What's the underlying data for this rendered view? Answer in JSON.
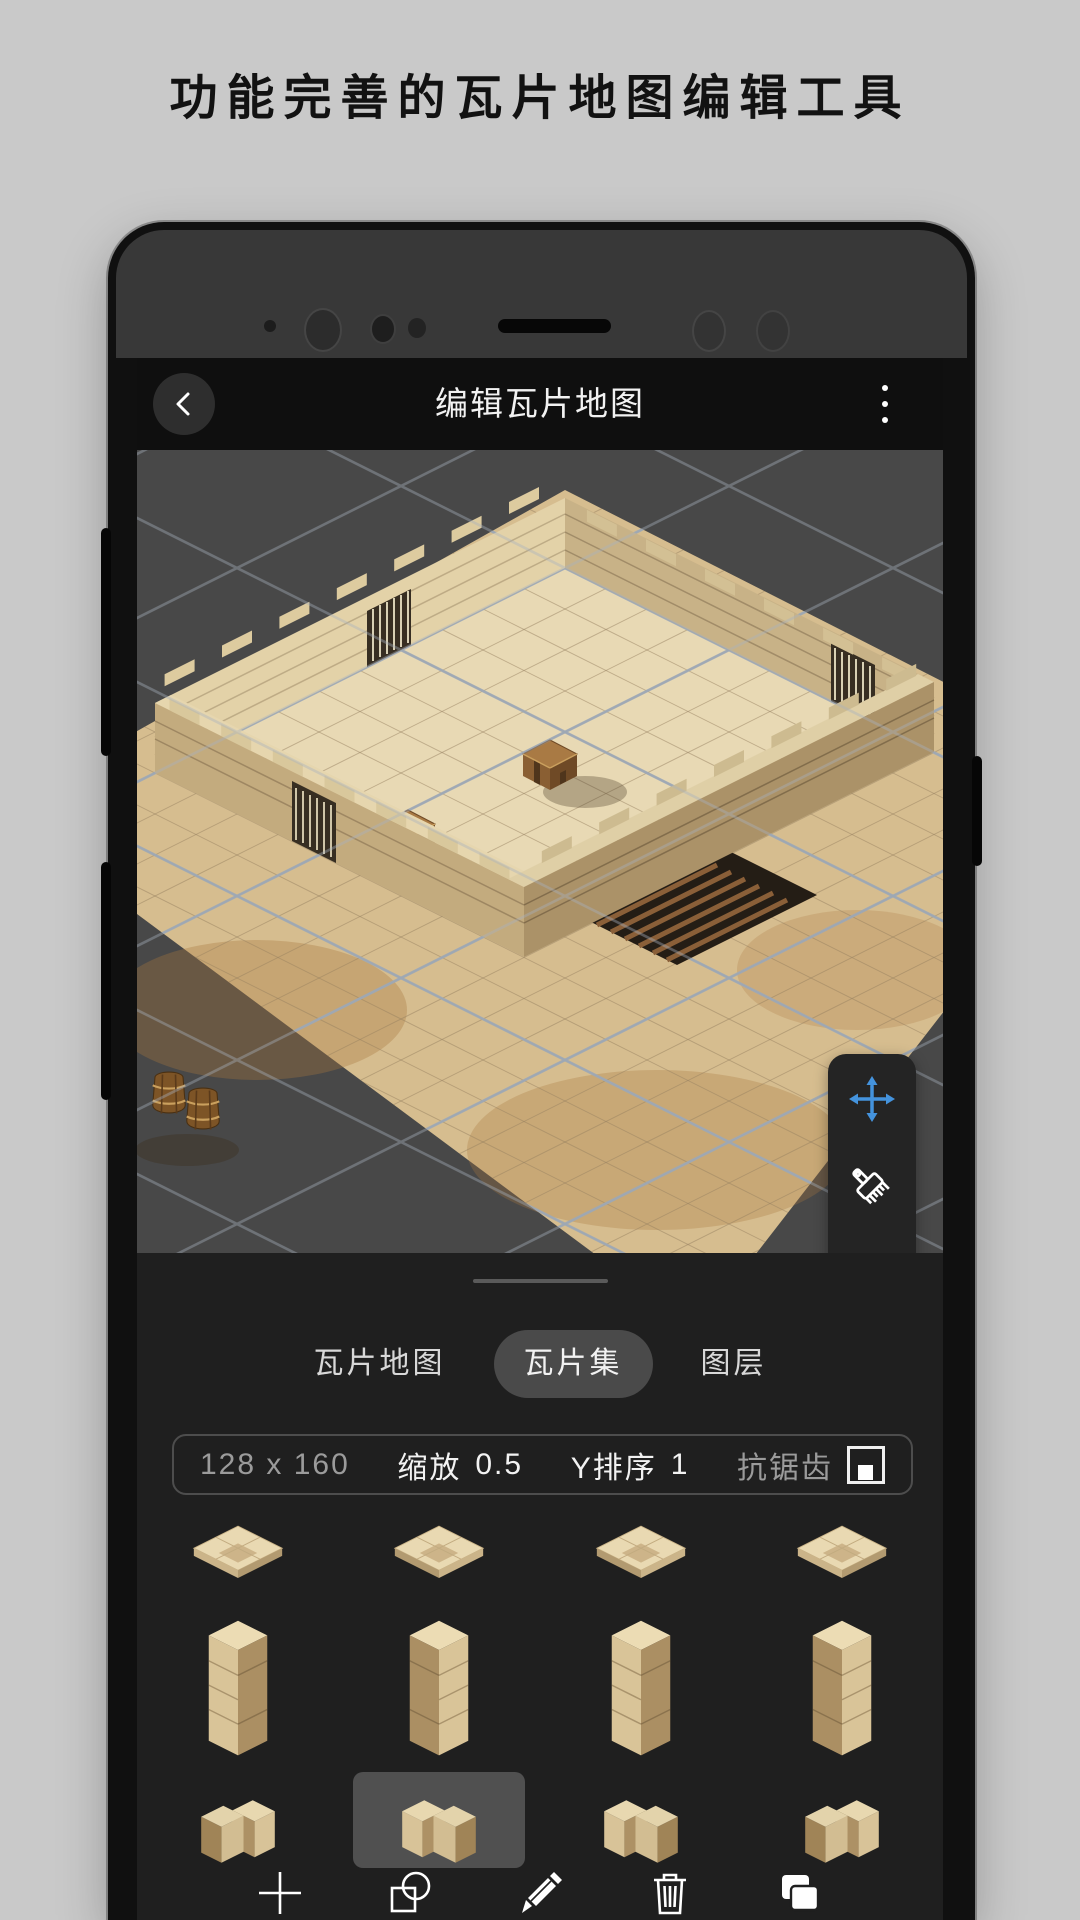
{
  "page": {
    "heading": "功能完善的瓦片地图编辑工具"
  },
  "app_bar": {
    "title": "编辑瓦片地图",
    "back_icon": "chevron-left-icon",
    "menu_icon": "vertical-ellipsis-icon"
  },
  "canvas": {
    "position_badge": "行 8，列 9",
    "scene": "isometric sandstone dungeon room with walls, barred doors, chests, barrels, wood grate and blue-grey grid overlay",
    "tool_panel": [
      {
        "name": "move-tool",
        "icon": "move-cross-icon",
        "color": "#4493dd"
      },
      {
        "name": "brush-tool",
        "icon": "paint-brush-icon",
        "color": "#ffffff"
      },
      {
        "name": "eraser-tool",
        "icon": "eraser-icon",
        "color": "#ffffff"
      }
    ]
  },
  "tabs": [
    {
      "label": "瓦片地图",
      "selected": false
    },
    {
      "label": "瓦片集",
      "selected": true
    },
    {
      "label": "图层",
      "selected": false
    }
  ],
  "tileset_bar": {
    "size": "128 x 160",
    "scale_label": "缩放",
    "scale_value": "0.5",
    "ysort_label": "Y排序",
    "ysort_value": "1",
    "antialias_label": "抗锯齿",
    "antialias_checked": true
  },
  "tiles": [
    {
      "name": "floor-tile-1",
      "shape": "floor",
      "selected": false
    },
    {
      "name": "floor-tile-2",
      "shape": "floor",
      "selected": false
    },
    {
      "name": "floor-tile-3",
      "shape": "floor",
      "selected": false
    },
    {
      "name": "floor-tile-4",
      "shape": "floor",
      "selected": false
    },
    {
      "name": "wall-tile-1",
      "shape": "wall",
      "selected": false
    },
    {
      "name": "wall-tile-2",
      "shape": "wall",
      "selected": false
    },
    {
      "name": "wall-tile-3",
      "shape": "wall",
      "selected": false
    },
    {
      "name": "wall-tile-4",
      "shape": "wall",
      "selected": false
    },
    {
      "name": "corner-tile-1",
      "shape": "corner",
      "selected": false
    },
    {
      "name": "corner-tile-2",
      "shape": "corner",
      "selected": true
    },
    {
      "name": "corner-tile-3",
      "shape": "corner",
      "selected": false
    },
    {
      "name": "corner-tile-4",
      "shape": "corner",
      "selected": false
    }
  ],
  "toolbar": [
    {
      "name": "add-button",
      "icon": "plus-icon"
    },
    {
      "name": "combine-shapes-button",
      "icon": "shape-combine-icon"
    },
    {
      "name": "edit-button",
      "icon": "pencil-icon"
    },
    {
      "name": "delete-button",
      "icon": "trash-icon"
    },
    {
      "name": "duplicate-button",
      "icon": "copy-stack-icon"
    }
  ],
  "colors": {
    "accent_blue": "#4493dd",
    "canvas_bg": "#484848",
    "section_bg": "#1f1f1f",
    "selection_bg": "#505050"
  }
}
